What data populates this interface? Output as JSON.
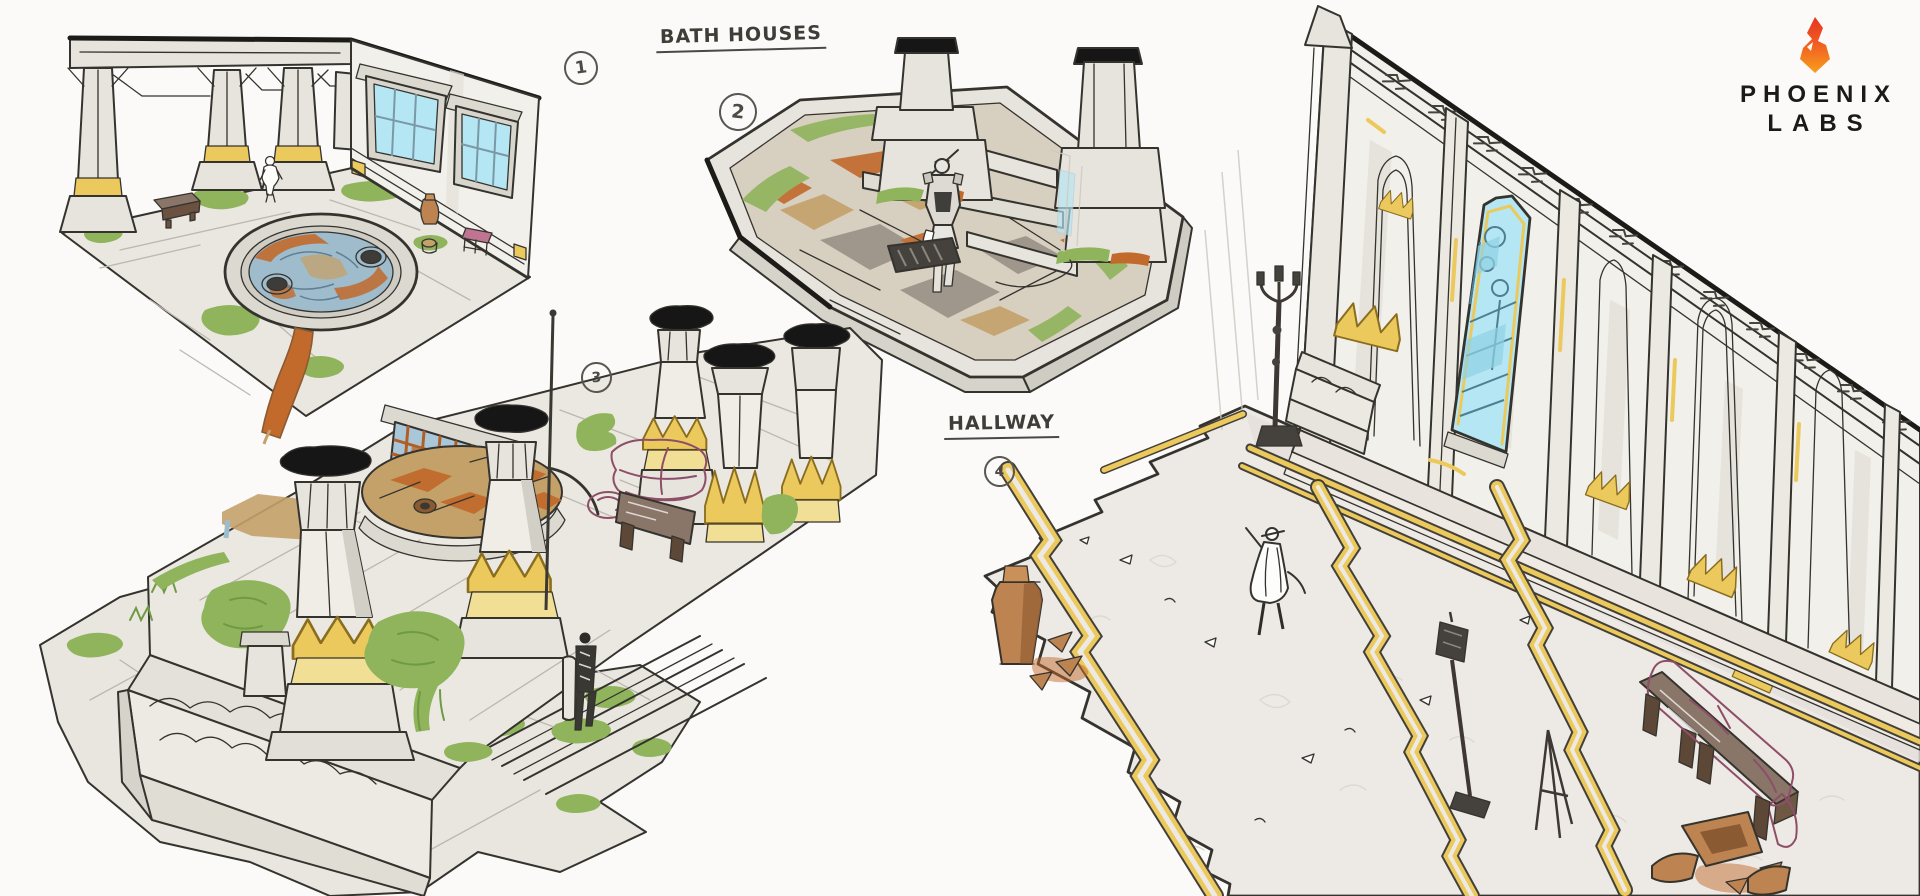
{
  "artwork": {
    "annotations": {
      "label_top": "BATH HOUSES",
      "label_right": "HALLWAY",
      "markers": [
        {
          "label": "1"
        },
        {
          "label": "2"
        },
        {
          "label": "3"
        },
        {
          "label": "4"
        }
      ]
    },
    "logo": {
      "line1": "PHOENIX",
      "line2": "LABS",
      "icon": "flame-icon"
    },
    "palette": {
      "paper": "#fbfaf8",
      "ink": "#35332e",
      "stone": "#e7e4dd",
      "gold": "#ecc95c",
      "moss": "#8fb45c",
      "rust": "#c16a2c",
      "tan": "#c4a169",
      "water": "#9fbccd",
      "glass": "#b5e6f3",
      "pink": "#bf7591",
      "wood": "#8a7668",
      "terracotta": "#bd8350",
      "black_cap": "#161616",
      "floor": "#edeae6",
      "flame_top": "#e63323",
      "flame_bottom": "#f99d1c"
    }
  }
}
